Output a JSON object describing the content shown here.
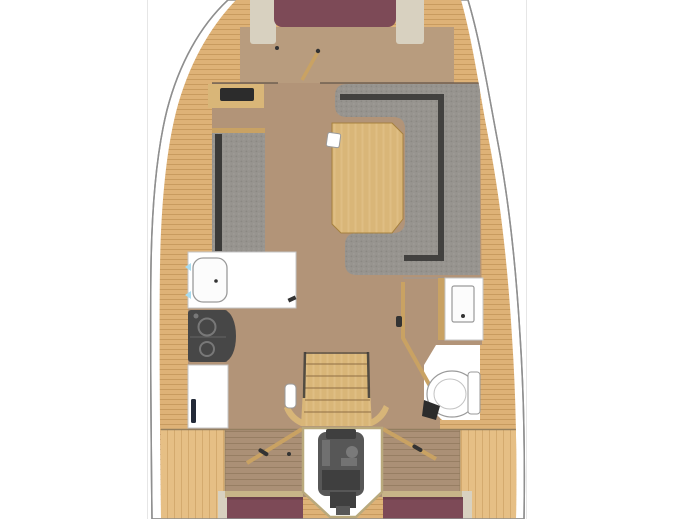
{
  "plan": {
    "type": "yacht-interior-deck-plan",
    "areas": [
      "forward-v-berth",
      "forward-cabin-floor",
      "port-locker-cabinet",
      "port-settee",
      "starboard-u-settee",
      "salon-table",
      "galley-sink-counter",
      "galley-stove",
      "galley-lower-counter",
      "head-vanity-sink",
      "head-toilet",
      "companionway-steps",
      "engine-compartment",
      "port-aft-berth",
      "starboard-aft-berth"
    ]
  },
  "colors": {
    "canvas_bg": "#ffffff",
    "frame_line": "#e6e6e6",
    "hull_stroke": "#8f8f8f",
    "hull_fill": "#ffffff",
    "deck_wood": "#deb277",
    "deck_plank": "#bf9254",
    "deck_wood_light": "#e6bf85",
    "fore_floor": "#b89c7e",
    "floor_brown": "#b29478",
    "aft_floor": "#ab9076",
    "floor_line": "#8d7b5c",
    "table_wood": "#d9b678",
    "table_grain": "#e2c28a",
    "table_edge": "#a6813f",
    "tread_line": "#8a6a40",
    "settee_gray": "#97948f",
    "settee_dot": "#8b8883",
    "settee_dot2": "#a19e99",
    "settee_dark": "#3b3a38",
    "maroon": "#7d4a57",
    "maroon_dark": "#683c48",
    "trim_beige": "#d8d1c0",
    "trim_tan": "#c7b488",
    "white": "#ffffff",
    "fixture_fill": "#fcfcfc",
    "fixture_stroke": "#9a9a9a",
    "fixture_light_stroke": "#c4c4c4",
    "stove_dark": "#474747",
    "stove_mid": "#787878",
    "engine_dark": "#575757",
    "engine_darker": "#3f3f3f",
    "engine_mid": "#7a7a7a",
    "engine_box_border": "#b9a97c",
    "wood_trim": "#c9a263",
    "wall_dark": "#5e5247",
    "handle_dark": "#333333",
    "inset_dark": "#2c2c2c",
    "navy_bar": "#232a38",
    "arrow_cyan": "#a8dcf0"
  }
}
